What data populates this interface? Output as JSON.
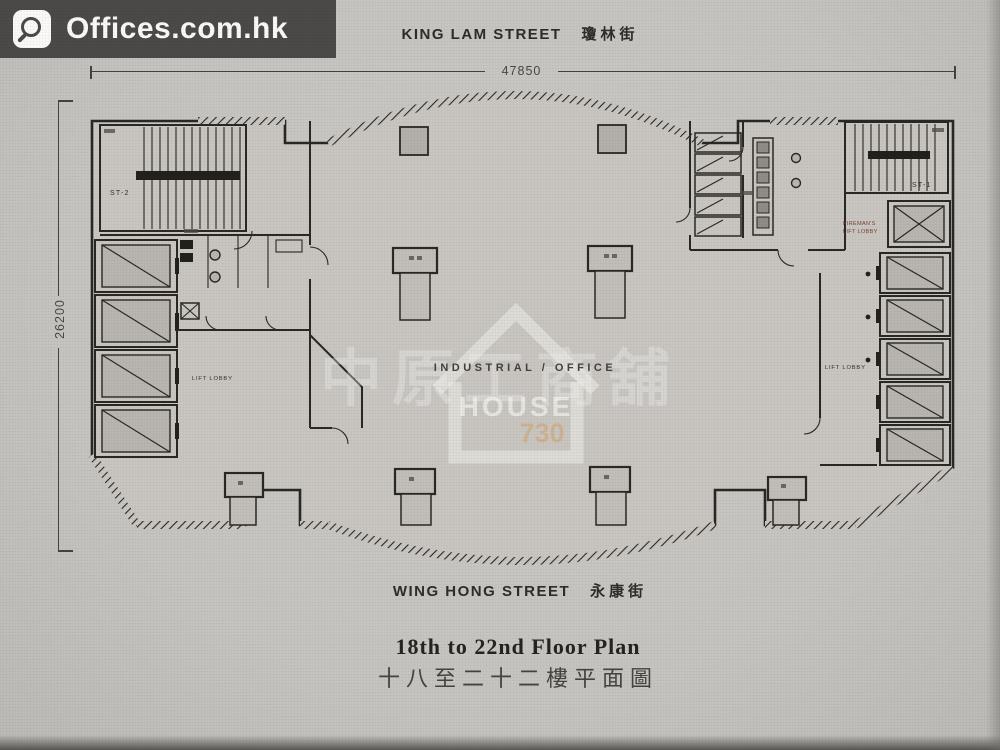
{
  "logo": {
    "text": "Offices.com.hk",
    "icon": "magnifier"
  },
  "top_street": {
    "en": "KING LAM STREET",
    "zh": "瓊林街"
  },
  "bottom_street": {
    "en": "WING HONG STREET",
    "zh": "永康街"
  },
  "dimensions": {
    "width": "47850",
    "depth": "26200"
  },
  "floor_title": {
    "en": "18th to 22nd Floor Plan",
    "zh": "十八至二十二樓平面圖"
  },
  "plan": {
    "stair_left": "ST-2",
    "stair_right": "ST-1",
    "lift_lobby_left": "LIFT LOBBY",
    "lift_lobby_right": "LIFT LOBBY",
    "fireman_lobby_line1": "FIREMAN'S",
    "fireman_lobby_line2": "LIFT LOBBY"
  },
  "watermark": {
    "cjk": "中原工商舖",
    "tagline": "INDUSTRIAL / OFFICE",
    "brand": "HOUSE",
    "brand_number": "730"
  },
  "colors": {
    "ink": "#2a2822",
    "paper": "#c7c5c1",
    "logo_bar": "#4b4a48",
    "fireman_text": "#7a4434",
    "brand_tan": "#d2a573"
  }
}
